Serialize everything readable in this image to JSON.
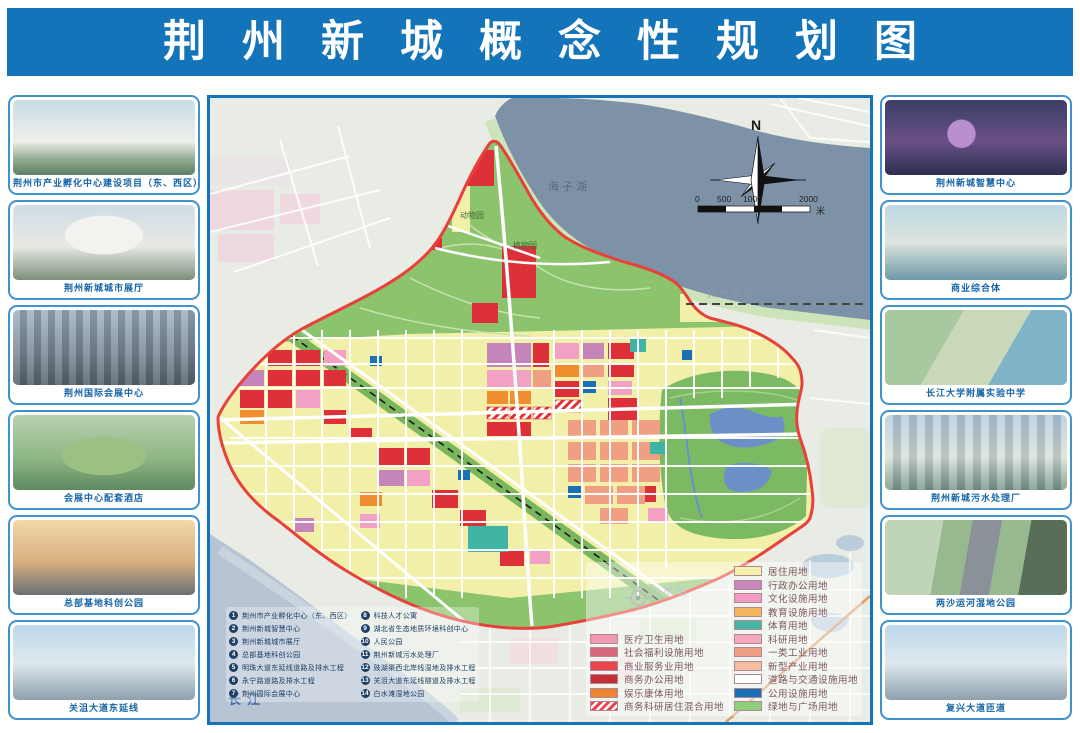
{
  "header": {
    "title": "荆州新城概念性规划图"
  },
  "left_projects": [
    {
      "caption": "荆州市产业孵化中心建设项目（东、西区）"
    },
    {
      "caption": "荆州新城城市展厅"
    },
    {
      "caption": "荆州国际会展中心"
    },
    {
      "caption": "会展中心配套酒店"
    },
    {
      "caption": "总部基地科创公园"
    },
    {
      "caption": "关沮大道东延线"
    }
  ],
  "right_projects": [
    {
      "caption": "荆州新城智慧中心"
    },
    {
      "caption": "商业综合体"
    },
    {
      "caption": "长江大学附属实验中学"
    },
    {
      "caption": "荆州新城污水处理厂"
    },
    {
      "caption": "两沙运河湿地公园"
    },
    {
      "caption": "复兴大道匝道"
    }
  ],
  "map": {
    "labels": {
      "lake": "海子湖",
      "river": "长江",
      "station": "沙市站",
      "pipeline": "川气东送",
      "zoo": "动物园",
      "botanic": "植物园",
      "north": "N"
    },
    "scale": {
      "ticks": [
        "0",
        "500",
        "1000",
        "2000"
      ],
      "unit": "米"
    },
    "legend_left": [
      {
        "label": "医疗卫生用地",
        "color": "#f29ab0"
      },
      {
        "label": "社会福利设施用地",
        "color": "#d6687a"
      },
      {
        "label": "商业服务业用地",
        "color": "#e8454e"
      },
      {
        "label": "商务办公用地",
        "color": "#c22f36"
      },
      {
        "label": "娱乐康体用地",
        "color": "#ef8432"
      },
      {
        "label": "商务科研居住混合用地",
        "color": "#e8454e",
        "hatched": true
      }
    ],
    "legend_right": [
      {
        "label": "居住用地",
        "color": "#f5f2ad"
      },
      {
        "label": "行政办公用地",
        "color": "#c786bd"
      },
      {
        "label": "文化设施用地",
        "color": "#f49ac6"
      },
      {
        "label": "教育设施用地",
        "color": "#f2b45c"
      },
      {
        "label": "体育用地",
        "color": "#45b5a6"
      },
      {
        "label": "科研用地",
        "color": "#f5a8bc"
      },
      {
        "label": "一类工业用地",
        "color": "#efa083"
      },
      {
        "label": "新型产业用地",
        "color": "#f4bda4"
      },
      {
        "label": "道路与交通设施用地",
        "color": "#ffffff"
      },
      {
        "label": "公用设施用地",
        "color": "#1b6fb5"
      },
      {
        "label": "绿地与广场用地",
        "color": "#8fce7a"
      }
    ],
    "project_index_left": [
      {
        "num": "1",
        "label": "荆州市产业孵化中心（东、西区）"
      },
      {
        "num": "2",
        "label": "荆州新城智慧中心"
      },
      {
        "num": "3",
        "label": "荆州新城城市展厅"
      },
      {
        "num": "4",
        "label": "总部基地科创公园"
      },
      {
        "num": "5",
        "label": "明珠大道东延线道路及排水工程"
      },
      {
        "num": "6",
        "label": "永宁路道路及排水工程"
      },
      {
        "num": "7",
        "label": "荆州国际会展中心"
      }
    ],
    "project_index_right": [
      {
        "num": "8",
        "label": "科技人才公寓"
      },
      {
        "num": "9",
        "label": "湖北省生态地质环境科创中心"
      },
      {
        "num": "10",
        "label": "人民公园"
      },
      {
        "num": "11",
        "label": "荆州新城污水处理厂"
      },
      {
        "num": "12",
        "label": "豉湖渠西北岸线湿地及排水工程"
      },
      {
        "num": "13",
        "label": "关沮大道东延线隧道及排水工程"
      },
      {
        "num": "14",
        "label": "白水滩湿地公园"
      }
    ]
  },
  "colors": {
    "header_blue": "#1474ba",
    "card_border": "#3f92cc",
    "caption_blue": "#1464a8",
    "boundary_red": "#e8413c",
    "water": "#7d92a6",
    "river": "#b8c4d4",
    "park_green": "#8cc46e",
    "residential_yellow": "#f2efa8",
    "commercial_red": "#dd3038",
    "industry_salmon": "#efa083"
  }
}
